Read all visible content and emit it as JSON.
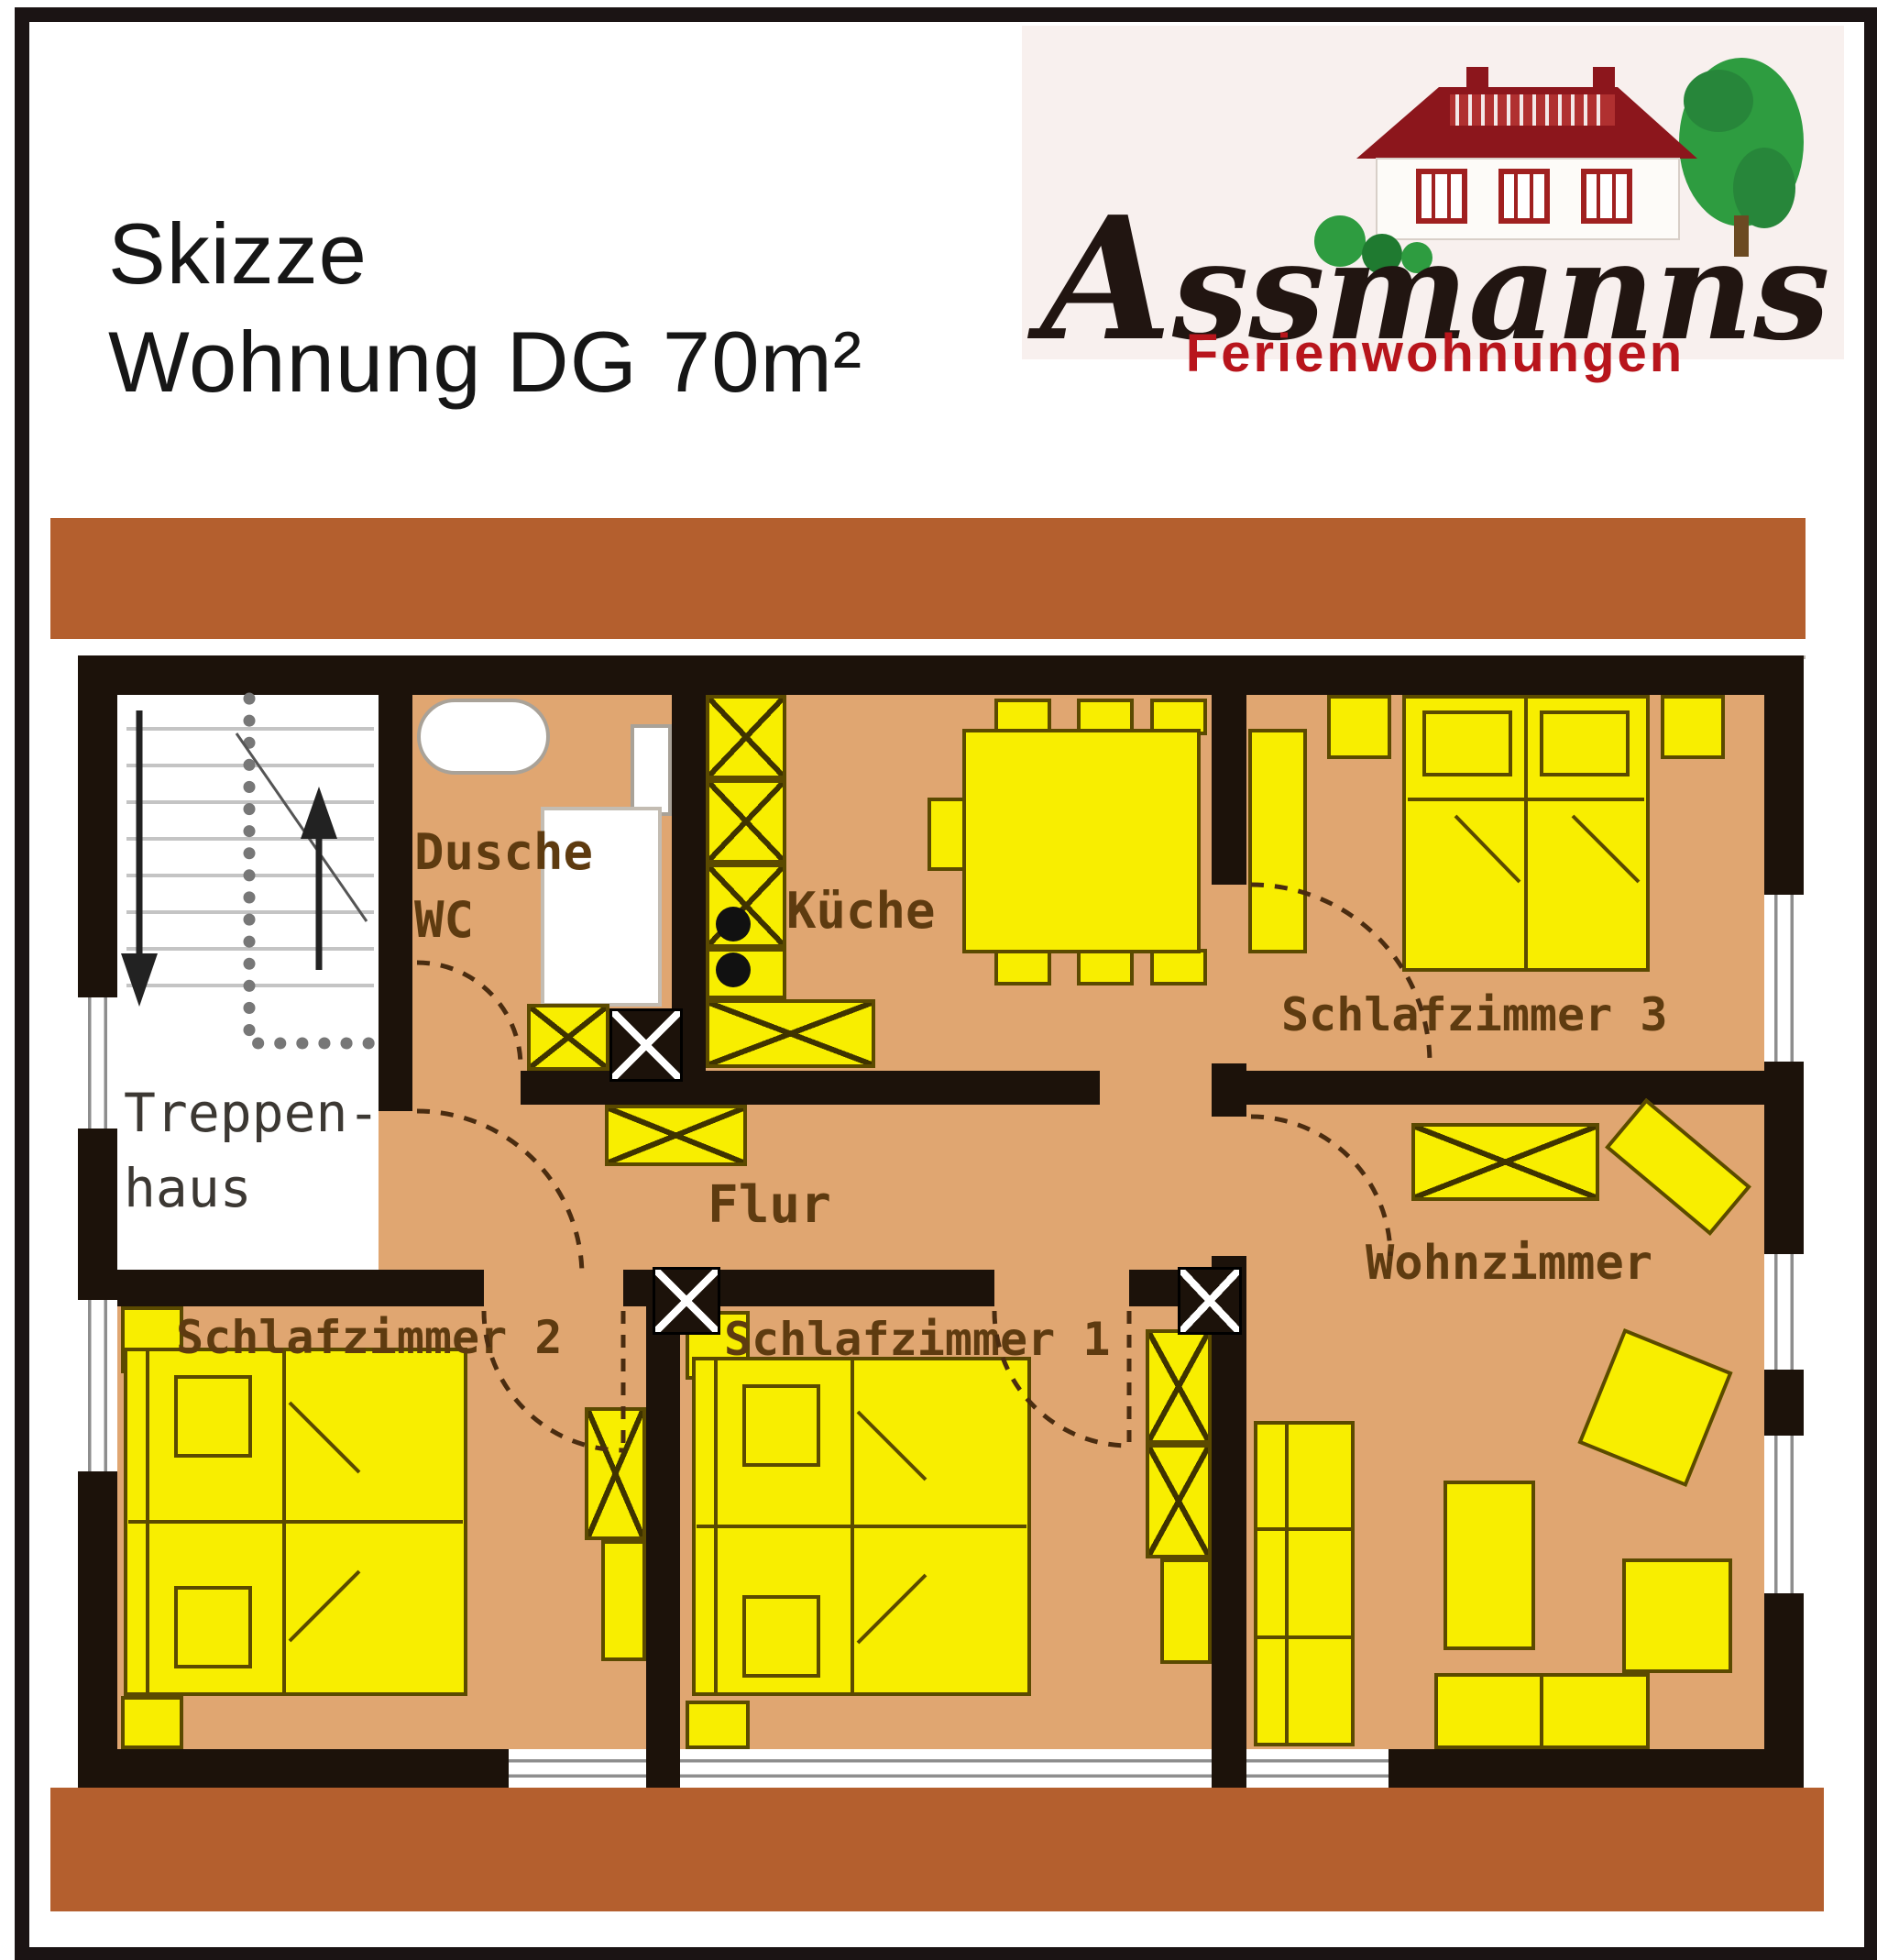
{
  "header": {
    "title_line1": "Skizze",
    "title_line2": "Wohnung DG 70m²",
    "brand": "Assmanns",
    "tagline": "Ferienwohnungen"
  },
  "plan": {
    "rooms": {
      "treppenhaus_line1": "Treppen-",
      "treppenhaus_line2": "haus",
      "dusche_line1": "Dusche",
      "dusche_line2": "WC",
      "kueche": "Küche",
      "schlafzimmer3": "Schlafzimmer 3",
      "flur": "Flur",
      "wohnzimmer": "Wohnzimmer",
      "schlafzimmer2": "Schlafzimmer 2",
      "schlafzimmer1": "Schlafzimmer 1"
    },
    "icons": [
      "stairs-down-arrow-icon",
      "stairs-up-arrow-icon",
      "door-swing-arc",
      "chimney-cross-icon",
      "wardrobe-cross-icon"
    ]
  },
  "colors": {
    "floor_tan": "#e0a671",
    "stairwell_white": "#ffffff",
    "wall_black": "#1c120a",
    "furniture_yellow": "#f8ee00",
    "furniture_outline": "#5b4a00",
    "terracotta_band": "#b45f2e",
    "logo_background": "#f8f0ee",
    "brand_ink": "#211511",
    "tagline_red": "#b8151c",
    "tree_green": "#2e9c40",
    "roof_red": "#8c161c",
    "label_brown": "#5e3b10"
  }
}
